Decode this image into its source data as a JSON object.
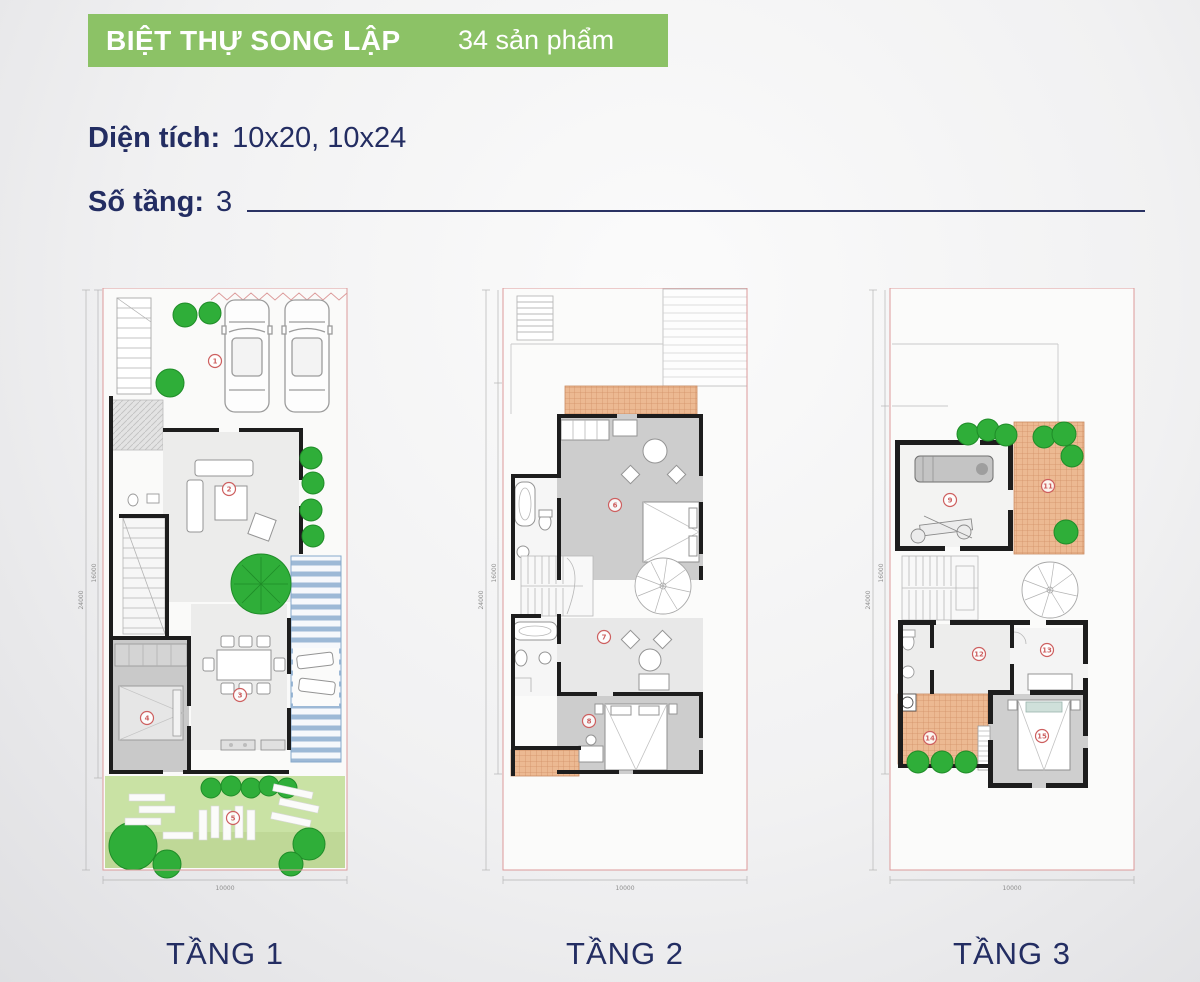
{
  "header": {
    "title": "BIỆT THỰ SONG LẬP",
    "count": "34 sản phẩm",
    "banner_color": "#8cc266"
  },
  "specs": {
    "area_label": "Diện tích:",
    "area_value": "10x20, 10x24",
    "floors_label": "Số tầng:",
    "floors_value": "3"
  },
  "plans": [
    {
      "caption": "TẦNG 1",
      "dims": {
        "left_outer": "24000",
        "left_inner": "16000",
        "bottom": "10000"
      },
      "markers": [
        "1",
        "2",
        "3",
        "4",
        "5"
      ]
    },
    {
      "caption": "TẦNG 2",
      "dims": {
        "left_outer": "24000",
        "left_inner": "16000",
        "bottom": "10000"
      },
      "markers": [
        "6",
        "7",
        "8"
      ]
    },
    {
      "caption": "TẦNG 3",
      "dims": {
        "left_outer": "24000",
        "left_inner": "16000",
        "bottom": "10000"
      },
      "markers": [
        "9",
        "11",
        "12",
        "13",
        "14",
        "15"
      ]
    }
  ],
  "colors": {
    "accent_green": "#8cc266",
    "navy_text": "#232d62",
    "tree_green": "#2fae39",
    "lawn_green": "#c9e2a4",
    "tile_orange": "#ecb992",
    "deck_blue": "#9db9d6",
    "boundary_pink": "#dc9a9a",
    "wall_black": "#1d1d1d",
    "marker_red": "#cd5f5f"
  }
}
